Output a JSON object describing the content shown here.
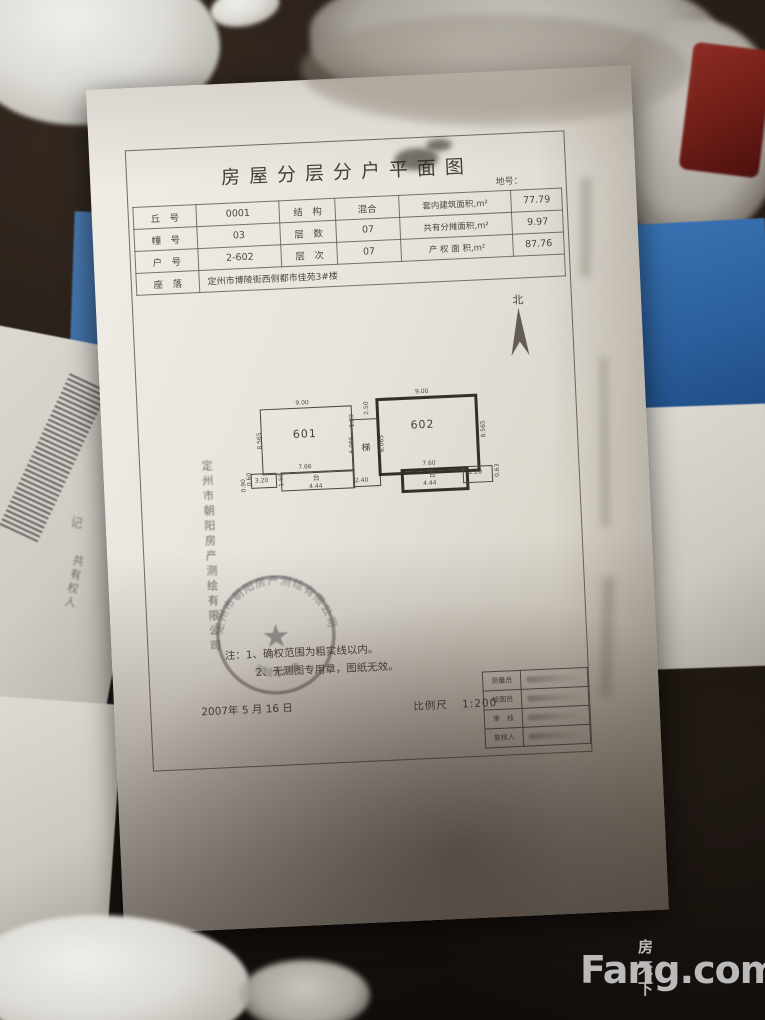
{
  "watermark": {
    "cn": "房天下",
    "en": "Fang.com"
  },
  "document": {
    "title": "房屋分层分户平面图",
    "land_no_label": "地号：",
    "info_table": {
      "rows": [
        {
          "c1": "丘　号",
          "c2": "0001",
          "c3": "结　构",
          "c4": "混合",
          "c5": "套内建筑面积,m²",
          "c6": "77.79"
        },
        {
          "c1": "幢　号",
          "c2": "03",
          "c3": "层　数",
          "c4": "07",
          "c5": "共有分摊面积,m²",
          "c6": "9.97"
        },
        {
          "c1": "户　号",
          "c2": "2-602",
          "c3": "层　次",
          "c4": "07",
          "c5": "产 权 面 积,m²",
          "c6": "87.76"
        },
        {
          "c1": "座　落",
          "addr": "定州市博陵街西侧都市佳苑3#楼"
        }
      ]
    },
    "north_label": "北",
    "plan": {
      "unit_left": {
        "label": "601",
        "top_dim": "9.00",
        "left_dim": "8.565",
        "bottom_dim": "7.66"
      },
      "unit_right": {
        "label": "602",
        "top_dim": "9.00",
        "right_dim": "8.565",
        "bottom_dim": "7.60"
      },
      "stair": {
        "label": "梯",
        "left_dim": "6.065",
        "right_dim": "6.065",
        "top_dim_v": "2.50",
        "top_dim_h": "1.20",
        "bottom_dim": "2.40"
      },
      "balcony_left": {
        "label": "台",
        "dim": "4.44",
        "side_dim": "1.50"
      },
      "balcony_right": {
        "label": "台",
        "dim": "4.44"
      },
      "annex_left": {
        "w_dim": "3.20",
        "h_dim": "0.60",
        "extra_dim": "0.90"
      },
      "annex_right": {
        "w_dim": "2.20",
        "h_dim": "0.63"
      }
    },
    "stamp": {
      "ring_text": "定州市朝阳房产测绘有限公司",
      "bottom_text": "测绘专用章",
      "star": "★"
    },
    "side_text": "定州市朝阳房产测绘有限公司",
    "notes": {
      "line1": "注：1、确权范围为粗实线以内。",
      "line2": "2、无测图专用章，图纸无效。"
    },
    "date": "2007年 5 月 16 日",
    "scale": {
      "label": "比例尺",
      "value": "1:200"
    },
    "sign_table": {
      "rows": [
        {
          "label": "测量员"
        },
        {
          "label": "绘图员"
        },
        {
          "label": "审　核"
        },
        {
          "label": "复核人"
        }
      ]
    }
  },
  "underlay": {
    "left_paper_label": "共有权人",
    "left_paper_mark": "记"
  }
}
